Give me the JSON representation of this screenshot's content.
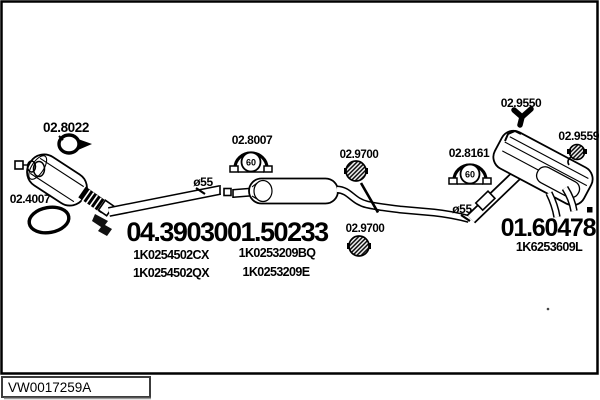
{
  "footer": {
    "code": "VW0017259A"
  },
  "parts": {
    "front_pipe": {
      "number": "04.39030",
      "refs": [
        "1K0254502CX",
        "1K0254502QX"
      ]
    },
    "mid_muffler": {
      "number": "01.50233",
      "refs": [
        "1K0253209BQ",
        "1K0253209E"
      ]
    },
    "rear_muffler": {
      "number": "01.60478",
      "refs": [
        "1K6253609L"
      ]
    }
  },
  "accessories": {
    "clamp_front": "02.8022",
    "ring_gasket_front": "02.4007",
    "flange_gasket_mid": "02.8007",
    "flange_gasket_rear": "02.8161",
    "rubber_hanger_mid_1": "02.9700",
    "rubber_hanger_mid_2": "02.9700",
    "bracket_rear_top": "02.9550",
    "rubber_hanger_rear": "02.9559"
  },
  "annotations": {
    "pipe_diameter_front": "ø55",
    "pipe_diameter_rear": "ø55",
    "gasket_inner_diameter": "60"
  },
  "colors": {
    "line": "#000000",
    "background": "#ffffff",
    "footer_box_border": "#3c3c3c",
    "footer_box_shadow": "#9a9a9a"
  }
}
